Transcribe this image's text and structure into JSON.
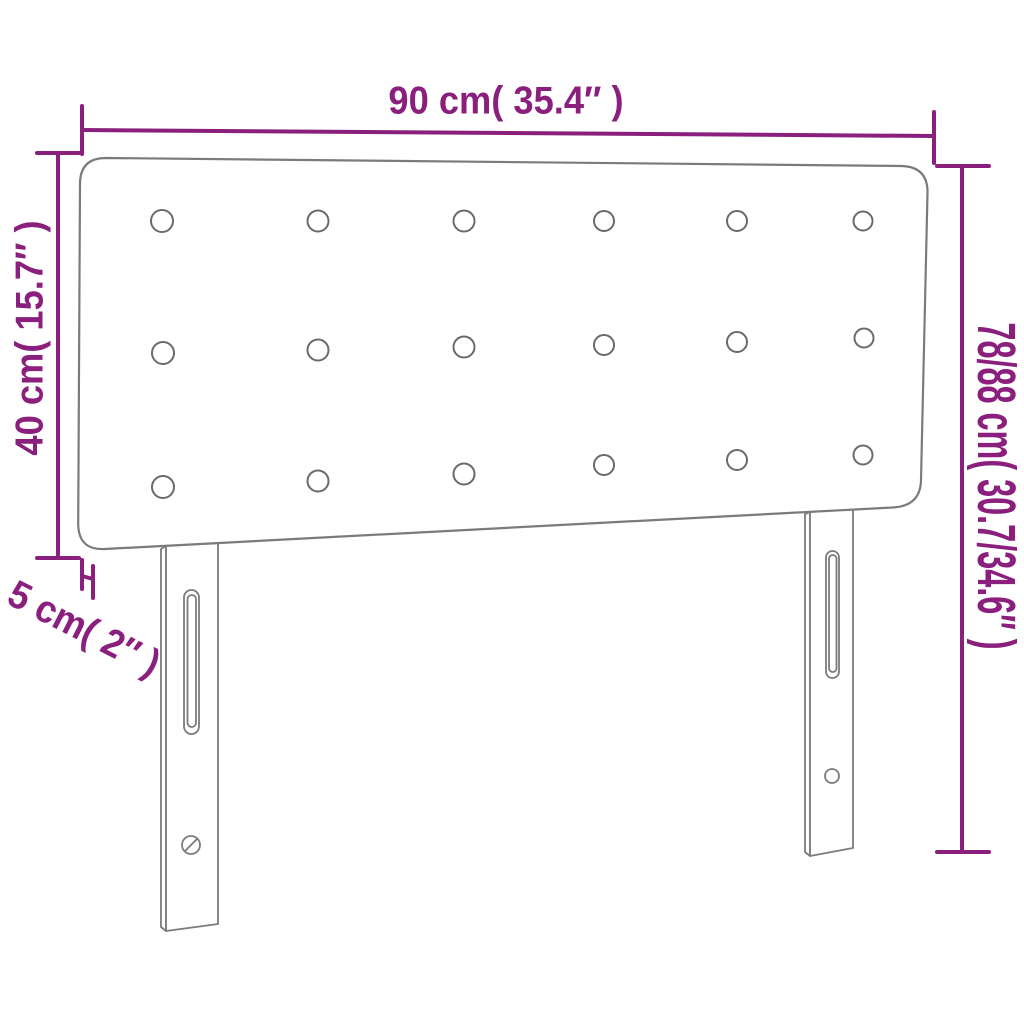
{
  "diagram": {
    "subject": "upholstered-headboard-with-two-legs",
    "colors": {
      "dimension_annotation": "#8a1f7d",
      "product_outline": "#7b7b7b",
      "background": "#ffffff"
    },
    "button_grid": {
      "rows": 3,
      "columns": 6
    },
    "labels": {
      "width": "90 cm( 35.4″ )",
      "upholstered_height": "40 cm( 15.7″ )",
      "total_height": "78/88 cm( 30.7/34.6″ )",
      "thickness": "5 cm( 2″ )"
    },
    "values": {
      "width_cm": "90",
      "width_in": "35.4",
      "upholstered_height_cm": "40",
      "upholstered_height_in": "15.7",
      "total_height_cm": "78/88",
      "total_height_in": "30.7/34.6",
      "thickness_cm": "5",
      "thickness_in": "2"
    }
  }
}
